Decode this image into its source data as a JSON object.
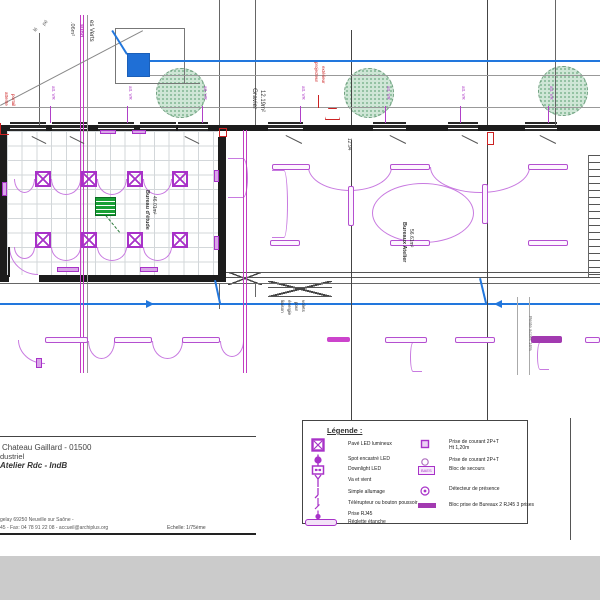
{
  "colors": {
    "purple": "#a832c8",
    "arc": "#c87ae0",
    "magenta": "#c23cc2",
    "blue": "#2277dd",
    "red": "#cc2222",
    "green": "#18a035",
    "wall": "#1c1c1c",
    "gray_strip": "#cbcbcb"
  },
  "titleblock": {
    "line1": "Chateau Gaillard - 01500",
    "line2": "dustriel",
    "line3": "Atelier Rdc - IndB",
    "footer1": "gelay 69250 Neuville sur Saône -",
    "footer2": "45 - Fax: 04 78 91 22 08 - accueil@archiplus.org",
    "scale_label": "Echelle: 1/75ème"
  },
  "legend": {
    "title": "Légende :",
    "left": [
      {
        "symbol": "pave-led",
        "label": "Pavé LED lumineux"
      },
      {
        "symbol": "spot-led",
        "label": "Spot encastré LED"
      },
      {
        "symbol": "downlight",
        "label": "Downlight LED"
      },
      {
        "symbol": "va-et-vient",
        "label": "Va et vient"
      },
      {
        "symbol": "simple-allumage",
        "label": "Simple allumage"
      },
      {
        "symbol": "telerupteur",
        "label": "Télérupteur ou bouton poussoir"
      },
      {
        "symbol": "rj45",
        "label": "Prise RJ45"
      },
      {
        "symbol": "reglette",
        "label": "Réglette étanche"
      }
    ],
    "right": [
      {
        "symbol": "prise-ht",
        "label": "Prise de courant 2P+T",
        "label2": "Ht 1,20m"
      },
      {
        "symbol": "prise",
        "label": "Prise de courant 2P+T"
      },
      {
        "symbol": "baes",
        "symbol_text": "BAES",
        "label": "Bloc de secours"
      },
      {
        "symbol": "detecteur",
        "label": "Détecteur de présence"
      },
      {
        "symbol": "bloc-prise",
        "label": "Bloc prise de Bureaux 2 RJ45 3 prises"
      }
    ]
  },
  "plan": {
    "grid_room": {
      "x": 7,
      "y": 131,
      "w": 211,
      "h": 144
    },
    "walls": [
      {
        "x": 0,
        "y": 125,
        "w": 600,
        "h": 6
      },
      {
        "x": 0,
        "y": 131,
        "w": 7,
        "h": 151
      },
      {
        "x": 218,
        "y": 137,
        "w": 8,
        "h": 145
      },
      {
        "x": 0,
        "y": 275,
        "w": 226,
        "h": 7
      }
    ],
    "windows": [
      {
        "x": 10,
        "w": 36
      },
      {
        "x": 52,
        "w": 36
      },
      {
        "x": 98,
        "w": 36
      },
      {
        "x": 140,
        "w": 36
      },
      {
        "x": 178,
        "w": 30
      },
      {
        "x": 268,
        "w": 35
      },
      {
        "x": 373,
        "w": 33
      },
      {
        "x": 448,
        "w": 30
      },
      {
        "x": 525,
        "w": 32
      }
    ],
    "trees": [
      {
        "cx": 180,
        "cy": 92,
        "r": 24
      },
      {
        "cx": 368,
        "cy": 92,
        "r": 24
      },
      {
        "cx": 562,
        "cy": 90,
        "r": 24
      }
    ],
    "blue_square": {
      "x": 127,
      "y": 53,
      "w": 21,
      "h": 22
    },
    "green_panel": {
      "x": 95,
      "y": 197,
      "w": 19,
      "h": 17
    },
    "ladder": {
      "x": 588,
      "y": 155,
      "w": 12,
      "h": 122
    },
    "fixtures": [
      [
        35,
        171
      ],
      [
        81,
        171
      ],
      [
        127,
        171
      ],
      [
        172,
        171
      ],
      [
        35,
        232
      ],
      [
        81,
        232
      ],
      [
        127,
        232
      ],
      [
        172,
        232
      ]
    ],
    "reglettes": [
      {
        "x": 272,
        "y": 164,
        "w": 38,
        "h": 6
      },
      {
        "x": 390,
        "y": 164,
        "w": 40,
        "h": 6
      },
      {
        "x": 528,
        "y": 164,
        "w": 40,
        "h": 6
      },
      {
        "x": 270,
        "y": 240,
        "w": 30,
        "h": 6
      },
      {
        "x": 390,
        "y": 240,
        "w": 40,
        "h": 6
      },
      {
        "x": 528,
        "y": 240,
        "w": 40,
        "h": 6
      },
      {
        "x": 348,
        "y": 186,
        "w": 6,
        "h": 40
      },
      {
        "x": 482,
        "y": 184,
        "w": 6,
        "h": 40
      },
      {
        "x": 45,
        "y": 337,
        "w": 43,
        "h": 6
      },
      {
        "x": 114,
        "y": 337,
        "w": 38,
        "h": 6
      },
      {
        "x": 182,
        "y": 337,
        "w": 38,
        "h": 6
      },
      {
        "x": 385,
        "y": 337,
        "w": 42,
        "h": 6
      },
      {
        "x": 455,
        "y": 337,
        "w": 40,
        "h": 6
      },
      {
        "x": 585,
        "y": 337,
        "w": 15,
        "h": 6
      },
      {
        "x": 531,
        "y": 336,
        "w": 31,
        "h": 7,
        "fill": "#a23ab0"
      },
      {
        "x": 327,
        "y": 337,
        "w": 23,
        "h": 5,
        "fill": "#cc44cc"
      }
    ],
    "arcs": [
      {
        "x": 14,
        "y": 179,
        "w": 21,
        "h": 14,
        "s": "b"
      },
      {
        "x": 51,
        "y": 179,
        "w": 30,
        "h": 16,
        "s": "b"
      },
      {
        "x": 97,
        "y": 179,
        "w": 30,
        "h": 16,
        "s": "b"
      },
      {
        "x": 143,
        "y": 179,
        "w": 29,
        "h": 16,
        "s": "b"
      },
      {
        "x": 14,
        "y": 247,
        "w": 21,
        "h": 12,
        "s": "b"
      },
      {
        "x": 51,
        "y": 247,
        "w": 30,
        "h": 14,
        "s": "b"
      },
      {
        "x": 97,
        "y": 247,
        "w": 30,
        "h": 14,
        "s": "b"
      },
      {
        "x": 143,
        "y": 247,
        "w": 29,
        "h": 14,
        "s": "b"
      },
      {
        "x": 308,
        "y": 167,
        "w": 84,
        "h": 24,
        "s": "b"
      },
      {
        "x": 430,
        "y": 167,
        "w": 100,
        "h": 26,
        "s": "b"
      },
      {
        "x": 372,
        "y": 183,
        "w": 102,
        "h": 60,
        "s": "o"
      },
      {
        "x": 272,
        "y": 170,
        "w": 16,
        "h": 68,
        "s": "r"
      },
      {
        "x": 228,
        "y": 158,
        "w": 20,
        "h": 40,
        "s": "r"
      },
      {
        "x": 88,
        "y": 341,
        "w": 27,
        "h": 18,
        "s": "b"
      },
      {
        "x": 152,
        "y": 341,
        "w": 31,
        "h": 18,
        "s": "b"
      },
      {
        "x": 220,
        "y": 341,
        "w": 24,
        "h": 16,
        "s": "b"
      },
      {
        "x": 18,
        "y": 340,
        "w": 27,
        "h": 24,
        "s": "q"
      },
      {
        "x": 410,
        "y": 342,
        "w": 12,
        "h": 30,
        "s": "l"
      },
      {
        "x": 537,
        "y": 342,
        "w": 12,
        "h": 28,
        "s": "l"
      },
      {
        "x": 9,
        "y": 247,
        "w": 29,
        "h": 28,
        "s": "q"
      }
    ],
    "outlets": [
      [
        2,
        182,
        5,
        14
      ],
      [
        214,
        170,
        5,
        12
      ],
      [
        214,
        236,
        5,
        14
      ],
      [
        57,
        267,
        22,
        5
      ],
      [
        140,
        267,
        18,
        5
      ],
      [
        100,
        130,
        16,
        4
      ],
      [
        132,
        130,
        14,
        4
      ],
      [
        36,
        358,
        6,
        10
      ]
    ],
    "xbraces": [
      [
        228,
        272,
        34,
        13
      ],
      [
        268,
        281,
        64,
        16
      ]
    ],
    "lines": [
      {
        "x": 39,
        "y": 33,
        "w": 1,
        "h": 92,
        "c": "#666"
      },
      {
        "x": 87,
        "y": 15,
        "w": 1,
        "h": 358,
        "c": "#999"
      },
      {
        "x": 219,
        "y": 0,
        "w": 1,
        "h": 125,
        "c": "#666"
      },
      {
        "x": 255,
        "y": 0,
        "w": 1,
        "h": 125,
        "c": "#666"
      },
      {
        "x": 351,
        "y": 30,
        "w": 1,
        "h": 95,
        "c": "#444"
      },
      {
        "x": 487,
        "y": 0,
        "w": 1,
        "h": 125,
        "c": "#444"
      },
      {
        "x": 555,
        "y": 0,
        "w": 1,
        "h": 125,
        "c": "#666"
      },
      {
        "x": 115,
        "y": 28,
        "w": 70,
        "h": 1,
        "c": "#777"
      },
      {
        "x": 115,
        "y": 28,
        "w": 1,
        "h": 55,
        "c": "#777"
      },
      {
        "x": 184,
        "y": 28,
        "w": 1,
        "h": 55,
        "c": "#777"
      },
      {
        "x": 115,
        "y": 83,
        "w": 85,
        "h": 1,
        "c": "#777"
      },
      {
        "x": 140,
        "y": 75,
        "w": 460,
        "h": 1,
        "c": "#999"
      },
      {
        "x": 0,
        "y": 107,
        "w": 600,
        "h": 1,
        "c": "#999"
      },
      {
        "x": 142,
        "y": 60,
        "w": 458,
        "h": 2,
        "c": "blue"
      },
      {
        "x": 9,
        "y": 275,
        "w": 30,
        "h": 7,
        "c": "#ffffff"
      },
      {
        "x": 8,
        "y": 247,
        "w": 2,
        "h": 30,
        "c": "#1c1c1c"
      },
      {
        "x": 226,
        "y": 272,
        "w": 374,
        "h": 1,
        "c": "#555"
      },
      {
        "x": 226,
        "y": 277,
        "w": 374,
        "h": 1,
        "c": "#555"
      },
      {
        "x": 0,
        "y": 283,
        "w": 600,
        "h": 1,
        "c": "#666"
      },
      {
        "x": 268,
        "y": 287,
        "w": 64,
        "h": 1,
        "c": "#555"
      },
      {
        "x": 268,
        "y": 296,
        "w": 64,
        "h": 1,
        "c": "#555"
      },
      {
        "x": 0,
        "y": 303,
        "w": 600,
        "h": 2,
        "c": "blue"
      },
      {
        "x": 351,
        "y": 140,
        "w": 1,
        "h": 280,
        "c": "#444"
      },
      {
        "x": 487,
        "y": 140,
        "w": 1,
        "h": 280,
        "c": "#444"
      },
      {
        "x": 219,
        "y": 283,
        "w": 1,
        "h": 26,
        "c": "#666"
      },
      {
        "x": 255,
        "y": 283,
        "w": 1,
        "h": 14,
        "c": "#666"
      },
      {
        "x": 517,
        "y": 297,
        "w": 1,
        "h": 78,
        "c": "#aaa"
      },
      {
        "x": 529,
        "y": 297,
        "w": 1,
        "h": 78,
        "c": "#aaa"
      },
      {
        "x": 570,
        "y": 418,
        "w": 1,
        "h": 122,
        "c": "#555"
      },
      {
        "x": 588,
        "y": 155,
        "w": 1,
        "h": 122,
        "c": "#666"
      },
      {
        "x": 80,
        "y": 15,
        "w": 1,
        "h": 358,
        "c": "magenta"
      },
      {
        "x": 83,
        "y": 15,
        "w": 1,
        "h": 358,
        "c": "magenta"
      },
      {
        "x": 243,
        "y": 130,
        "w": 1,
        "h": 243,
        "c": "magenta"
      },
      {
        "x": 246,
        "y": 130,
        "w": 1,
        "h": 243,
        "c": "magenta"
      },
      {
        "x": 50,
        "y": 106,
        "w": 1,
        "h": 17,
        "c": "#b040c8"
      },
      {
        "x": 127,
        "y": 106,
        "w": 1,
        "h": 17,
        "c": "#b040c8"
      },
      {
        "x": 202,
        "y": 106,
        "w": 1,
        "h": 17,
        "c": "#b040c8"
      },
      {
        "x": 300,
        "y": 106,
        "w": 1,
        "h": 17,
        "c": "#b040c8"
      },
      {
        "x": 385,
        "y": 106,
        "w": 1,
        "h": 17,
        "c": "#b040c8"
      },
      {
        "x": 460,
        "y": 106,
        "w": 1,
        "h": 17,
        "c": "#b040c8"
      },
      {
        "x": 548,
        "y": 106,
        "w": 1,
        "h": 17,
        "c": "#b040c8"
      },
      {
        "x": 318,
        "y": 95,
        "w": 1,
        "h": 13,
        "c": "red"
      },
      {
        "x": 0,
        "y": 436,
        "w": 256,
        "h": 1,
        "c": "#444"
      },
      {
        "x": 0,
        "y": 533,
        "w": 256,
        "h": 2,
        "c": "#222"
      },
      {
        "x": 0,
        "y": 556,
        "w": 600,
        "h": 44,
        "c": "#cbcbcb"
      }
    ],
    "diagonals": [
      {
        "x1": 0,
        "y1": 105,
        "x2": 143,
        "y2": 30,
        "c": "#888",
        "t": 1
      },
      {
        "x1": 113,
        "y1": 30,
        "x2": 128,
        "y2": 54,
        "c": "blue",
        "t": 1.5
      },
      {
        "x1": 216,
        "y1": 280,
        "x2": 221,
        "y2": 303,
        "c": "blue",
        "t": 1.5
      },
      {
        "x1": 481,
        "y1": 278,
        "x2": 487,
        "y2": 303,
        "c": "blue",
        "t": 1.5
      },
      {
        "x1": 286,
        "y1": 135,
        "x2": 302,
        "y2": 143,
        "c": "#555",
        "t": 1
      },
      {
        "x1": 390,
        "y1": 135,
        "x2": 406,
        "y2": 143,
        "c": "#555",
        "t": 1
      },
      {
        "x1": 462,
        "y1": 135,
        "x2": 478,
        "y2": 143,
        "c": "#555",
        "t": 1
      },
      {
        "x1": 540,
        "y1": 135,
        "x2": 556,
        "y2": 143,
        "c": "#555",
        "t": 1
      },
      {
        "x1": 32,
        "y1": 136,
        "x2": 46,
        "y2": 143,
        "c": "#555",
        "t": 1
      },
      {
        "x1": 70,
        "y1": 136,
        "x2": 84,
        "y2": 143,
        "c": "#555",
        "t": 1
      },
      {
        "x1": 185,
        "y1": 136,
        "x2": 199,
        "y2": 143,
        "c": "#555",
        "t": 1
      },
      {
        "x1": 106,
        "y1": 215,
        "x2": 120,
        "y2": 232,
        "c": "#2a7a3a",
        "t": 1,
        "dash": true
      }
    ],
    "red_marks": [
      {
        "x": 325,
        "y": 108,
        "w": 15,
        "h": 12,
        "kind": "trap"
      },
      {
        "x": 0,
        "y": 123,
        "w": 9,
        "h": 12,
        "kind": "corner"
      },
      {
        "x": 219,
        "y": 128,
        "w": 8,
        "h": 9,
        "kind": "box"
      },
      {
        "x": 487,
        "y": 132,
        "w": 7,
        "h": 13,
        "kind": "box"
      }
    ],
    "arrows": [
      {
        "x": 146,
        "y": 304,
        "d": "r"
      },
      {
        "x": 494,
        "y": 304,
        "d": "l"
      }
    ],
    "annotations": [
      {
        "text": "lé",
        "x": 33,
        "y": 30,
        "rot": -50,
        "size": 5,
        "color": "#555"
      },
      {
        "text": "pé",
        "x": 42,
        "y": 24,
        "rot": -50,
        "size": 5,
        "color": "#555"
      },
      {
        "text": ".06m²",
        "x": 66,
        "y": 22,
        "rot": 90,
        "size": 5.5,
        "color": "#444"
      },
      {
        "text": "subd",
        "x": 75,
        "y": 24,
        "rot": 90,
        "size": 5.5,
        "color": "#b03ab8",
        "bold": true
      },
      {
        "text": "es Verts",
        "x": 86,
        "y": 20,
        "rot": 90,
        "size": 6,
        "color": "#333"
      },
      {
        "text": "Gravier",
        "x": 248,
        "y": 88,
        "rot": 90,
        "size": 6.5,
        "color": "#333"
      },
      {
        "text": "12.19m²",
        "x": 257,
        "y": 90,
        "rot": 90,
        "size": 6,
        "color": "#333"
      },
      {
        "text": "att. VR",
        "x": 48,
        "y": 86,
        "rot": 90,
        "size": 4.5,
        "color": "#b040c8"
      },
      {
        "text": "att. VR",
        "x": 125,
        "y": 86,
        "rot": 90,
        "size": 4.5,
        "color": "#b040c8"
      },
      {
        "text": "att. VR",
        "x": 200,
        "y": 86,
        "rot": 90,
        "size": 4.5,
        "color": "#b040c8"
      },
      {
        "text": "att. VR",
        "x": 298,
        "y": 86,
        "rot": 90,
        "size": 4.5,
        "color": "#b040c8"
      },
      {
        "text": "att. VR",
        "x": 383,
        "y": 86,
        "rot": 90,
        "size": 4.5,
        "color": "#b040c8"
      },
      {
        "text": "att. VR",
        "x": 458,
        "y": 86,
        "rot": 90,
        "size": 4.5,
        "color": "#b040c8"
      },
      {
        "text": "att. VR",
        "x": 546,
        "y": 86,
        "rot": 90,
        "size": 4.5,
        "color": "#b040c8"
      },
      {
        "text": "projecteur",
        "x": 311,
        "y": 62,
        "rot": 90,
        "size": 4.5,
        "color": "#cc2222"
      },
      {
        "text": "extérieur",
        "x": 318,
        "y": 66,
        "rot": 90,
        "size": 4.5,
        "color": "#cc2222"
      },
      {
        "text": "attente",
        "x": 1,
        "y": 92,
        "rot": 90,
        "size": 4.5,
        "color": "#cc2222"
      },
      {
        "text": "portail",
        "x": 8,
        "y": 94,
        "rot": 90,
        "size": 4.5,
        "color": "#cc2222"
      },
      {
        "text": "12.94",
        "x": 344,
        "y": 138,
        "rot": 90,
        "size": 5,
        "color": "#444"
      },
      {
        "text": "Bureau d'étude",
        "x": 141,
        "y": 190,
        "rot": 90,
        "size": 5.5,
        "color": "#333",
        "bold": true
      },
      {
        "text": "46.01m²",
        "x": 149,
        "y": 196,
        "rot": 90,
        "size": 5,
        "color": "#333"
      },
      {
        "text": "Bureaux Atelier",
        "x": 398,
        "y": 222,
        "rot": 90,
        "size": 5.5,
        "color": "#333",
        "bold": true
      },
      {
        "text": "56.61m²",
        "x": 406,
        "y": 229,
        "rot": 90,
        "size": 5,
        "color": "#333"
      },
      {
        "text": "liaison",
        "x": 277,
        "y": 300,
        "rot": 90,
        "size": 4.5,
        "color": "#333"
      },
      {
        "text": "énergie",
        "x": 284,
        "y": 300,
        "rot": 90,
        "size": 4.5,
        "color": "#333"
      },
      {
        "text": "pour",
        "x": 291,
        "y": 302,
        "rot": 90,
        "size": 4.5,
        "color": "#333"
      },
      {
        "text": "volets",
        "x": 298,
        "y": 300,
        "rot": 90,
        "size": 4.5,
        "color": "#333"
      },
      {
        "text": "Pente accès 16%",
        "x": 525,
        "y": 316,
        "rot": 90,
        "size": 4.5,
        "color": "#666"
      }
    ]
  }
}
